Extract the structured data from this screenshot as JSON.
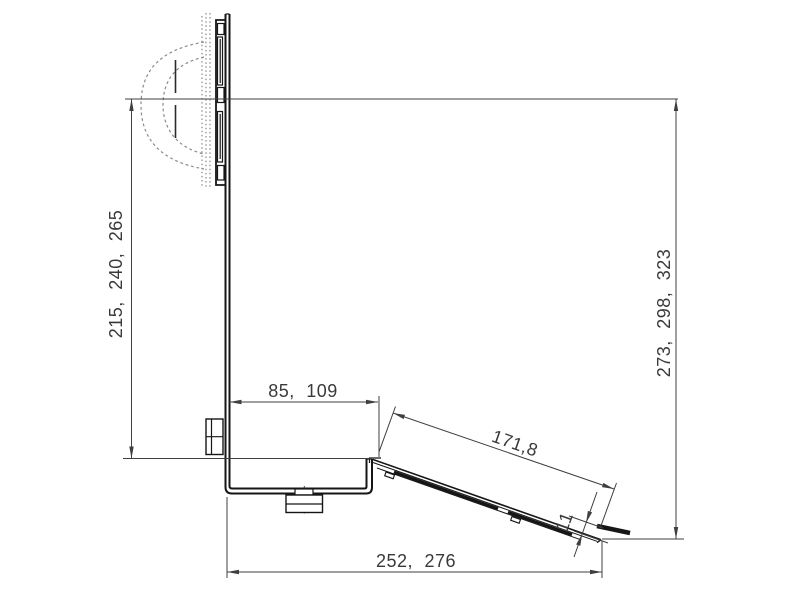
{
  "drawing": {
    "type": "technical-dimension-drawing",
    "description": "Side view of a speaker wall bracket with tilted tray and dimension lines",
    "colors": {
      "background": "#ffffff",
      "object_line": "#161616",
      "dimension_line": "#3f3f3f",
      "hidden_line": "#8a8a8a",
      "text": "#3a3a3a"
    },
    "dimensions": {
      "left_height": "215, 240, 265",
      "right_height": "273, 298, 323",
      "foot_depth": "85, 109",
      "tray_length": "171,8",
      "lip_height": "11",
      "base_depth": "252, 276"
    }
  }
}
